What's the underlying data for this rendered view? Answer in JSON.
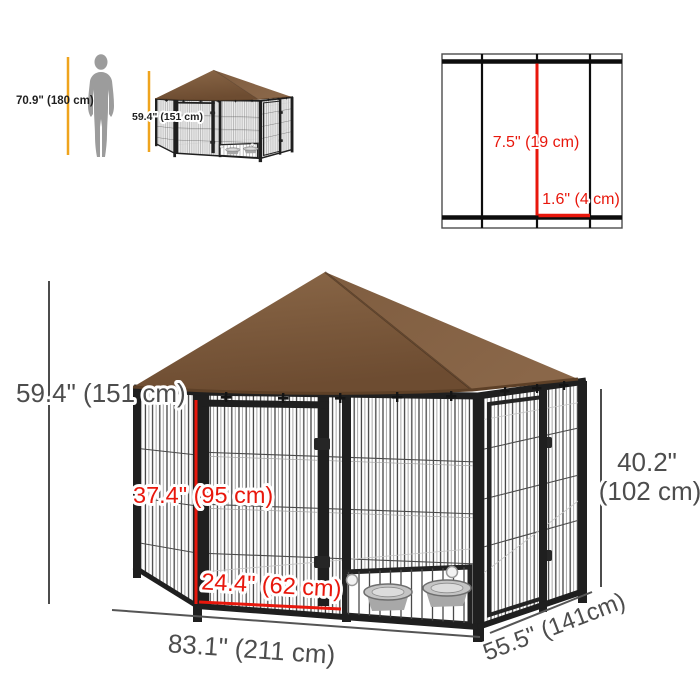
{
  "product": {
    "type_label": "outdoor dog kennel with canopy dimension diagram"
  },
  "scale_figures": {
    "human_label": "70.9\" (180 cm)",
    "kennel_label": "59.4\" (151 cm)"
  },
  "mesh_diagram": {
    "vertical_gap_label": "7.5\" (19 cm)",
    "horizontal_gap_label": "1.6\" (4 cm)"
  },
  "kennel_dimensions": {
    "overall_height": "59.4\" (151 cm)",
    "door_height": "37.4\" (95 cm)",
    "door_width": "24.4\" (62 cm)",
    "length": "83.1\" (211 cm)",
    "depth": "55.5\" (141cm)",
    "panel_height_inches": "40.2\"",
    "panel_height_cm": "(102 cm)"
  },
  "colors": {
    "canopy_brown": "#7a573a",
    "canopy_brown_dark": "#6d4c31",
    "canopy_brown_light": "#8b6848",
    "accent_yellow": "#efa41d",
    "dimension_red": "#e8170c",
    "dimension_gray": "#4d4d4d",
    "frame_black": "#1f1f1f",
    "silhouette_gray": "#9c9c9c",
    "bowl_gray": "#c4c4c4"
  }
}
